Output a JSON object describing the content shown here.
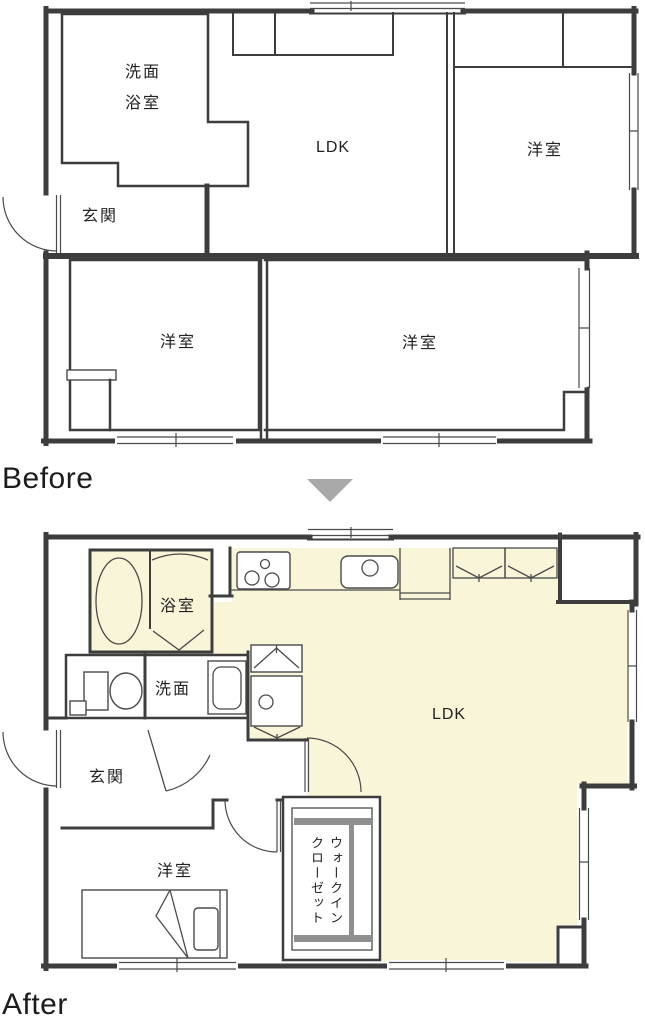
{
  "colors": {
    "plan_fill": "#f8f5d8",
    "arrow_gray": "#a9a9a9",
    "closet_rod_gray": "#8f8f8f"
  },
  "before_plan": {
    "title": "Before",
    "labels": {
      "washroom": "洗面",
      "bathroom": "浴室",
      "entrance": "玄関",
      "ldk": "LDK",
      "western_room_top": "洋室",
      "western_room_left": "洋室",
      "western_room_right": "洋室"
    }
  },
  "transition": {
    "arrow_icon": "down-triangle-arrow"
  },
  "after_plan": {
    "title": "After",
    "labels": {
      "bathroom": "浴室",
      "washroom": "洗面",
      "entrance": "玄関",
      "ldk": "LDK",
      "western_room": "洋室",
      "walk_in_closet_line1": "ウォークイン",
      "walk_in_closet_line2": "クローゼット"
    }
  }
}
